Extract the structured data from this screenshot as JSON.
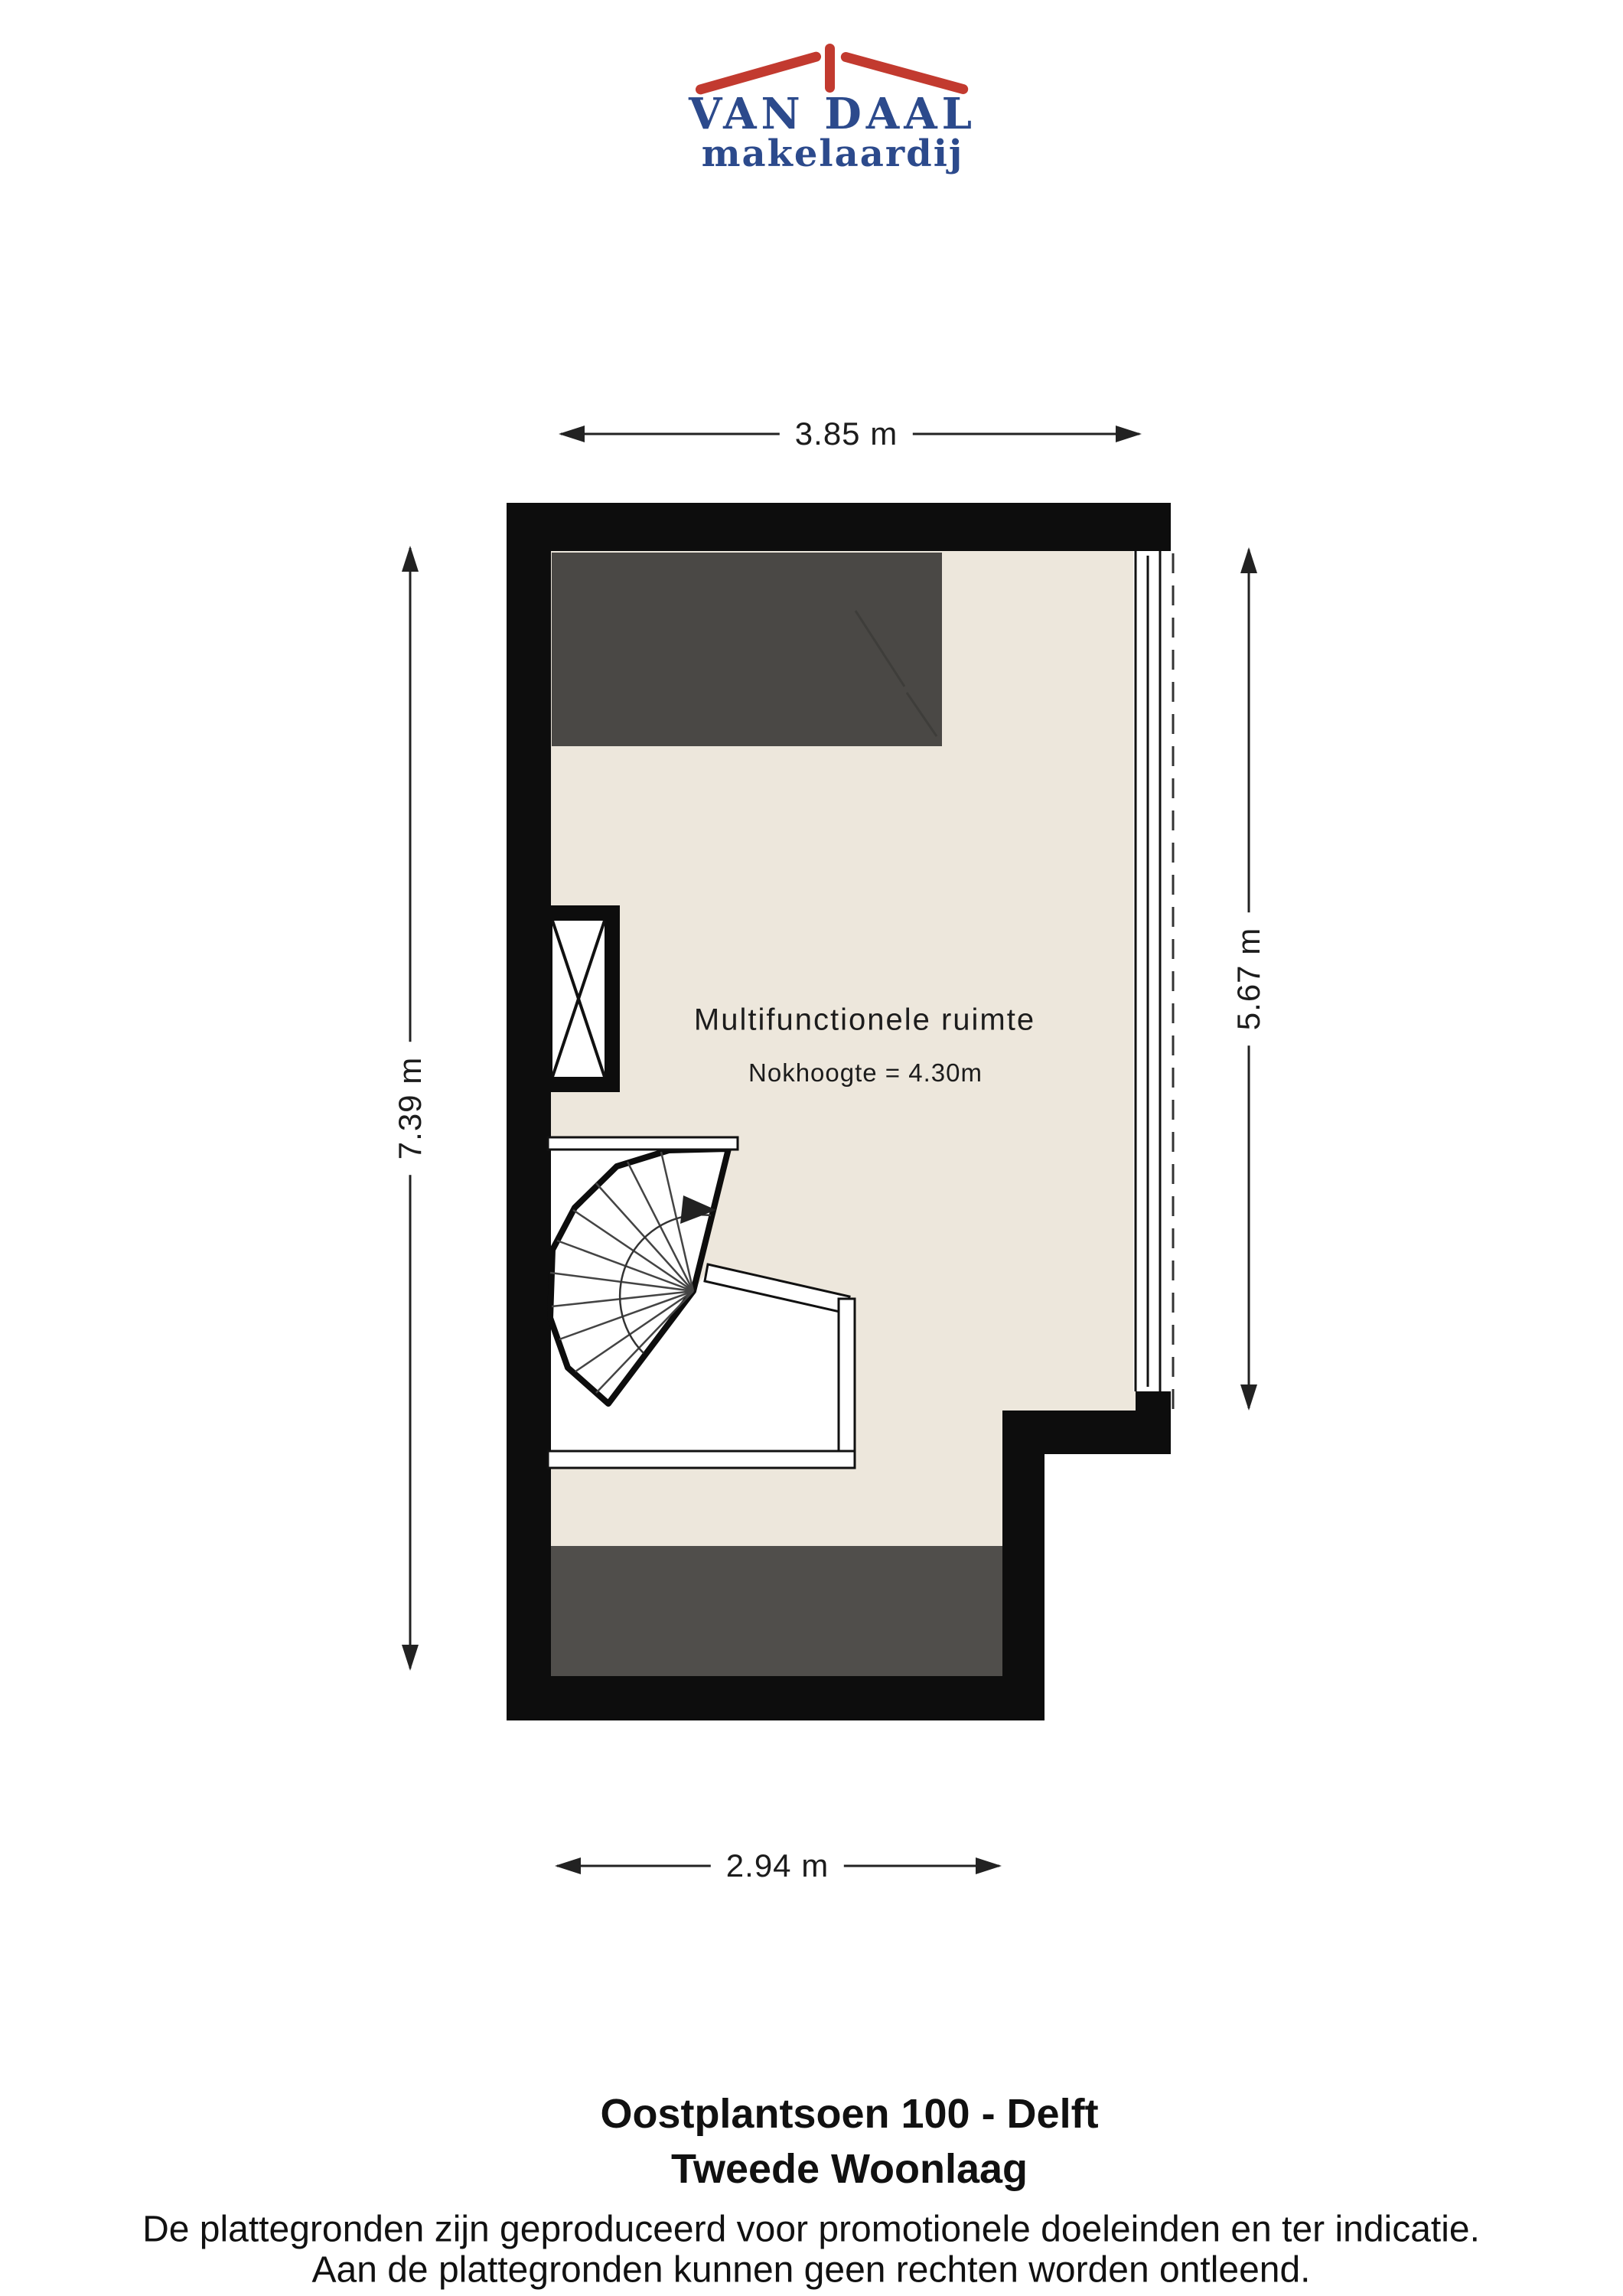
{
  "logo": {
    "name": "VAN DAAL",
    "tagline": "makelaardij",
    "roof_color": "#C23A2F",
    "text_color": "#2C4A8C"
  },
  "floor_plan": {
    "room": {
      "label": "Multifunctionele ruimte",
      "note": "Nokhoogte = 4.30m"
    },
    "dimensions": {
      "top": "3.85 m",
      "left": "7.39 m",
      "right": "5.67 m",
      "bottom": "2.94 m"
    },
    "features": [
      "spiral-staircase",
      "stairwell-void",
      "window-strip",
      "shaft-with-cross",
      "sloped-ceiling-zones"
    ],
    "colors": {
      "floor": "#EDE7DC",
      "dark_zone": "#4A4845",
      "wall": "#111111"
    }
  },
  "footer": {
    "address": "Oostplantsoen 100 - Delft",
    "floor_name": "Tweede Woonlaag",
    "disclaimer_line1": "De plattegronden zijn geproduceerd voor promotionele doeleinden en ter indicatie.",
    "disclaimer_line2": "Aan de plattegronden kunnen geen rechten worden ontleend."
  }
}
